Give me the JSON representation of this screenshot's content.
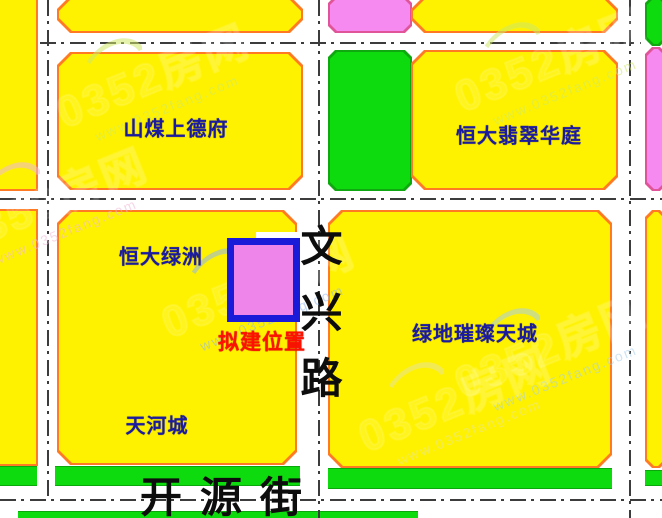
{
  "parcels": [
    {
      "label": "山煤上德府"
    },
    {
      "label": "恒大翡翠华庭"
    },
    {
      "label": "恒大绿洲"
    },
    {
      "label": "绿地璀璨天城"
    },
    {
      "label": "天河城"
    }
  ],
  "roads": [
    {
      "label": "文兴路",
      "orientation": "vertical"
    },
    {
      "label": "开源街",
      "orientation": "horizontal"
    }
  ],
  "proposed_site": {
    "label": "拟建位置"
  },
  "watermark": {
    "brand": "0352房网",
    "url": "www.0352fang.com"
  },
  "colors": {
    "parcel_yellow": "#fff200",
    "parcel_green": "#0ddb0d",
    "parcel_pink": "#f78af0",
    "parcel_border": "#ff7a22",
    "site_fill": "#ee85ea",
    "site_border": "#1a1ad9",
    "label_blue": "#1b1b9e",
    "proposed_text_red": "#ff1100",
    "road_line": "#3c3c3c"
  }
}
